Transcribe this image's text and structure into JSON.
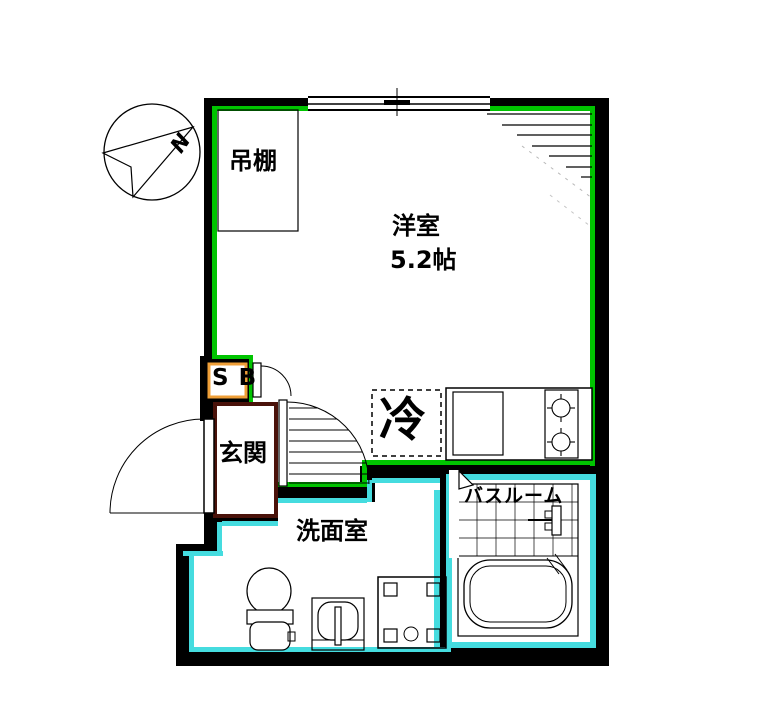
{
  "colors": {
    "room_accent": "#00C400",
    "water_accent": "#45DCDF",
    "entrance_accent": "#4A120A",
    "storage_accent": "#EF9F38"
  },
  "labels": {
    "compass_north": "N",
    "hanging_shelf": "吊棚",
    "western_room_name": "洋室",
    "western_room_size": "5.2帖",
    "shoe_box": "S B",
    "entrance": "玄関",
    "refrigerator": "冷",
    "bathroom": "バスルーム",
    "washroom": "洗面室"
  }
}
